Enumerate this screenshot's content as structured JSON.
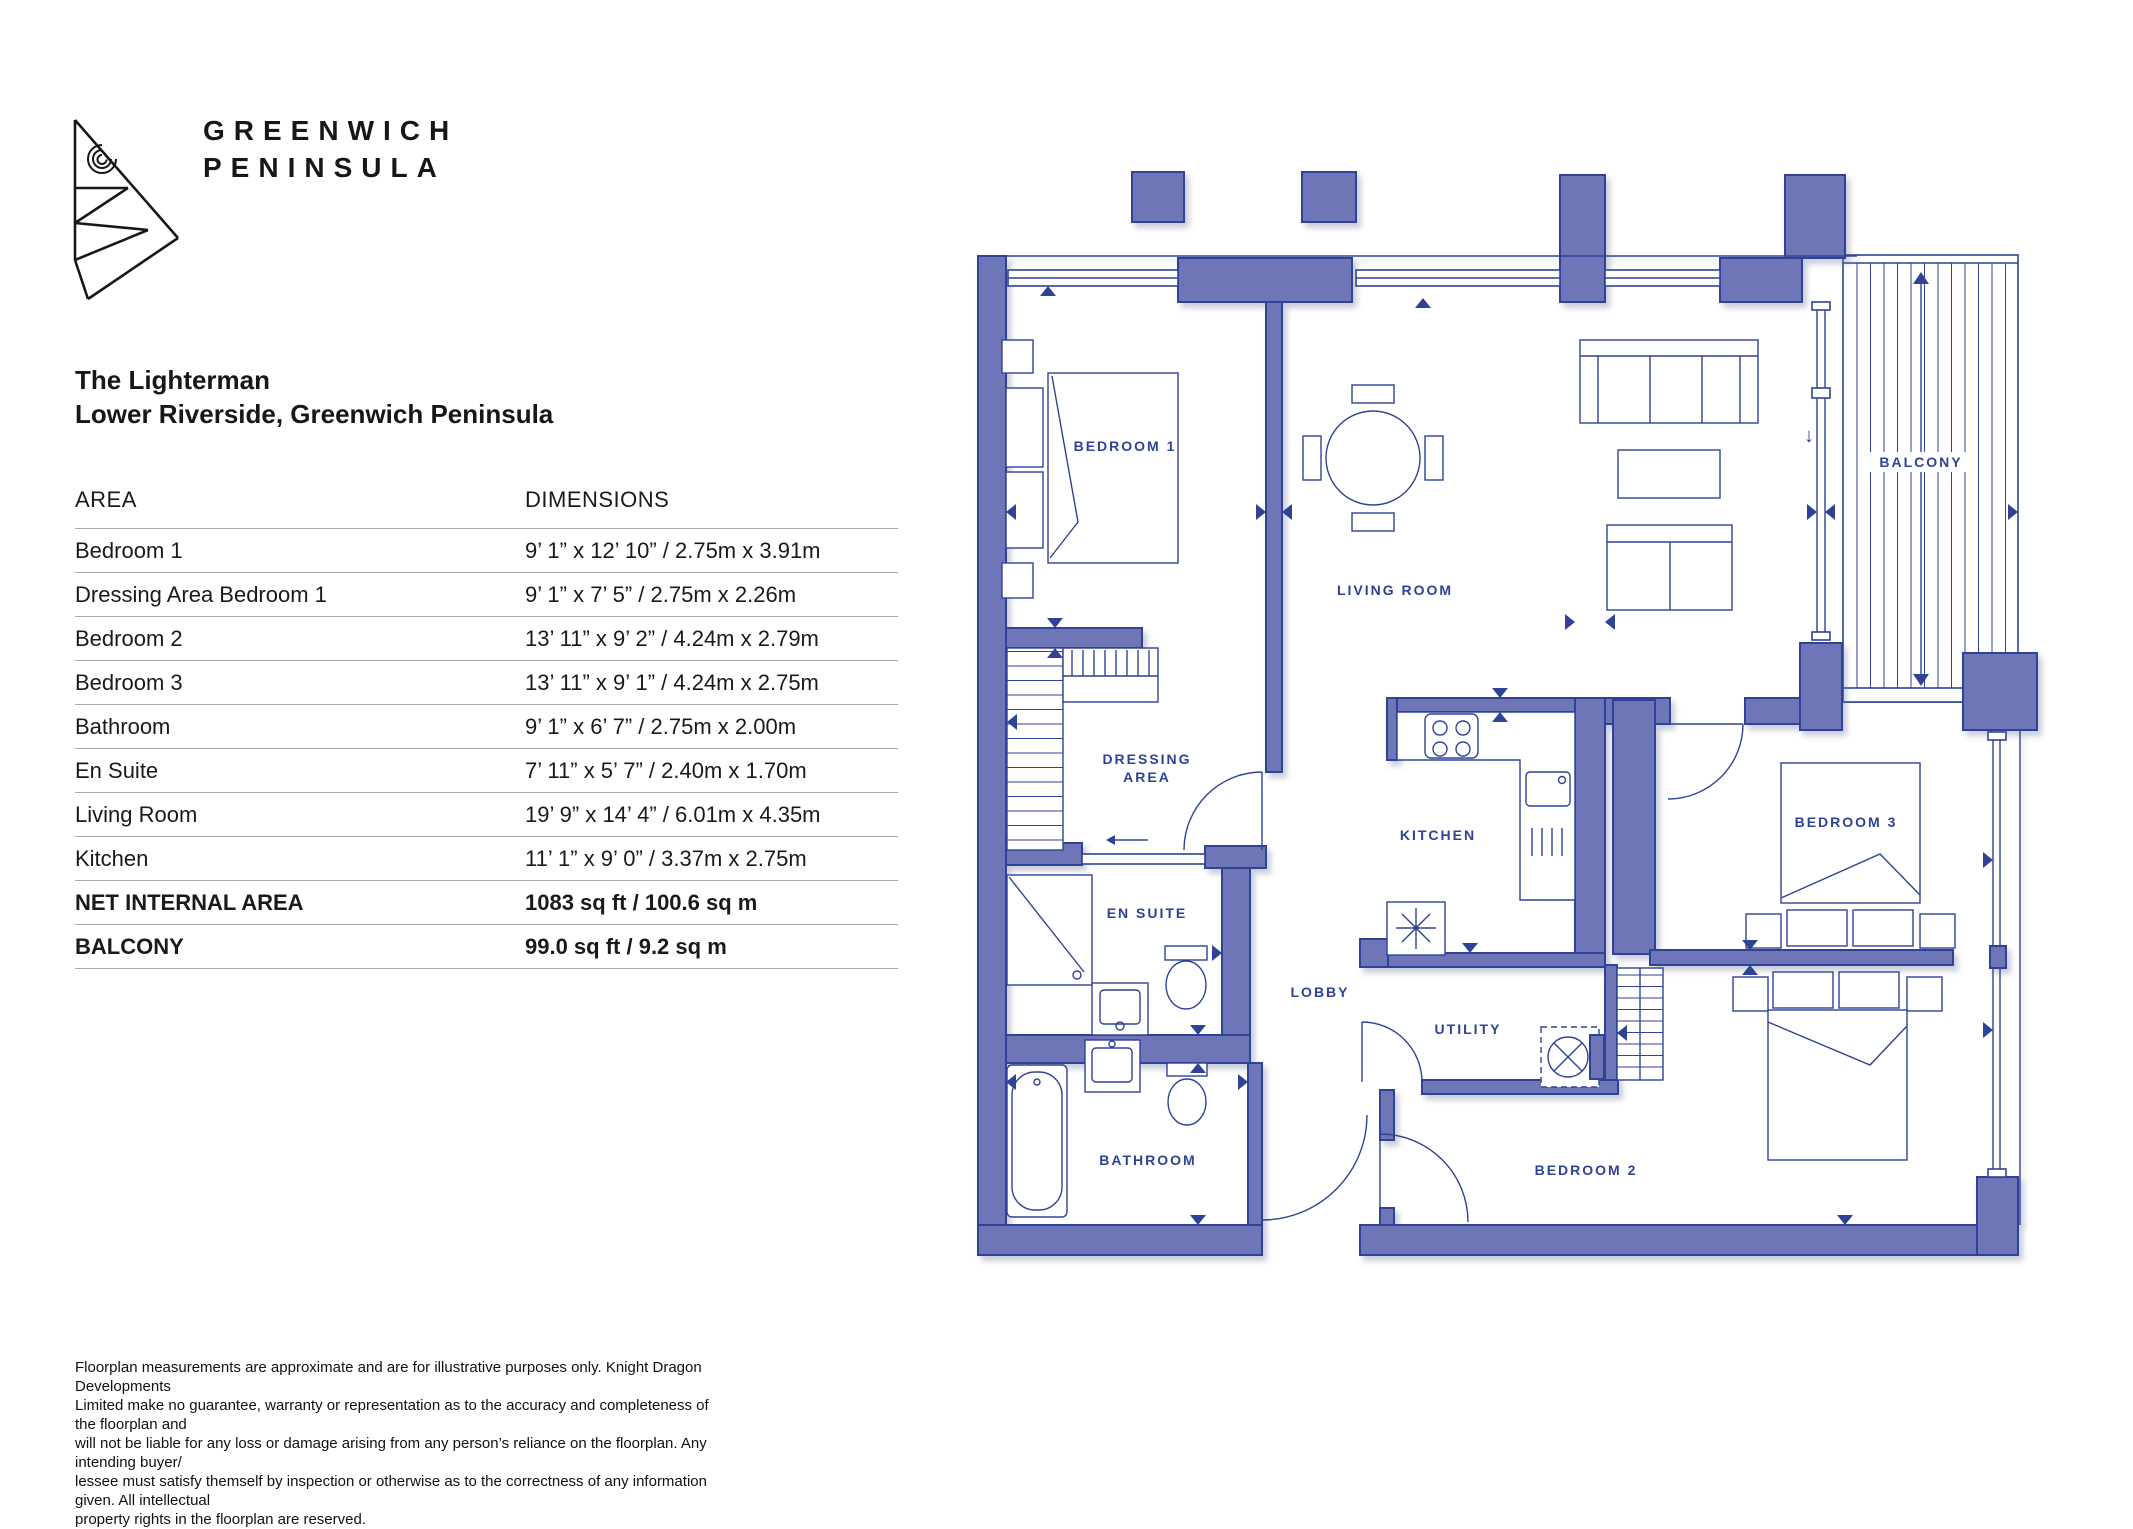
{
  "brand": {
    "line1": "GREENWICH",
    "line2": "PENINSULA"
  },
  "header": {
    "title": "The Lighterman",
    "subtitle": "Lower Riverside, Greenwich Peninsula"
  },
  "table": {
    "col_area": "AREA",
    "col_dimensions": "DIMENSIONS",
    "rows": [
      {
        "area": "Bedroom 1",
        "dims": "9’ 1” x 12’ 10” / 2.75m x 3.91m"
      },
      {
        "area": "Dressing Area Bedroom 1",
        "dims": "9’ 1” x 7’ 5” / 2.75m x 2.26m"
      },
      {
        "area": "Bedroom 2",
        "dims": "13’ 11” x 9’ 2” / 4.24m x 2.79m"
      },
      {
        "area": "Bedroom 3",
        "dims": "13’ 11” x 9’ 1” / 4.24m x 2.75m"
      },
      {
        "area": "Bathroom",
        "dims": "9’ 1” x 6’ 7” / 2.75m x 2.00m"
      },
      {
        "area": "En Suite",
        "dims": "7’ 11” x 5’ 7” / 2.40m x 1.70m"
      },
      {
        "area": "Living Room",
        "dims": "19’ 9” x 14’ 4” / 6.01m x 4.35m"
      },
      {
        "area": "Kitchen",
        "dims": "11’ 1” x 9’ 0” / 3.37m x 2.75m"
      }
    ],
    "totals": [
      {
        "area": "NET INTERNAL AREA",
        "dims": "1083 sq ft / 100.6 sq m"
      },
      {
        "area": "BALCONY",
        "dims": "99.0 sq ft / 9.2 sq m"
      }
    ]
  },
  "floorplan": {
    "labels": {
      "bedroom1": "BEDROOM 1",
      "living_room": "LIVING ROOM",
      "balcony": "BALCONY",
      "dressing1": "DRESSING",
      "dressing2": "AREA",
      "kitchen": "KITCHEN",
      "bedroom3": "BEDROOM 3",
      "en_suite": "EN SUITE",
      "lobby": "LOBBY",
      "utility": "UTILITY",
      "bathroom": "BATHROOM",
      "bedroom2": "BEDROOM 2",
      "balcony_door_arrow": "↓"
    },
    "colors": {
      "wall_fill": "#6e76b8",
      "line": "#2e4396"
    }
  },
  "disclaimer": {
    "lines": [
      "Floorplan measurements are approximate and are for illustrative purposes only. Knight Dragon Developments",
      "Limited make no guarantee, warranty or representation as to the accuracy and completeness of the floorplan and",
      "will not be liable for any loss or damage arising from any person’s reliance on the floorplan. Any intending buyer/",
      "lessee must satisfy themself by inspection or otherwise as to the correctness of any information given. All intellectual",
      "property rights in the floorplan are reserved."
    ]
  }
}
